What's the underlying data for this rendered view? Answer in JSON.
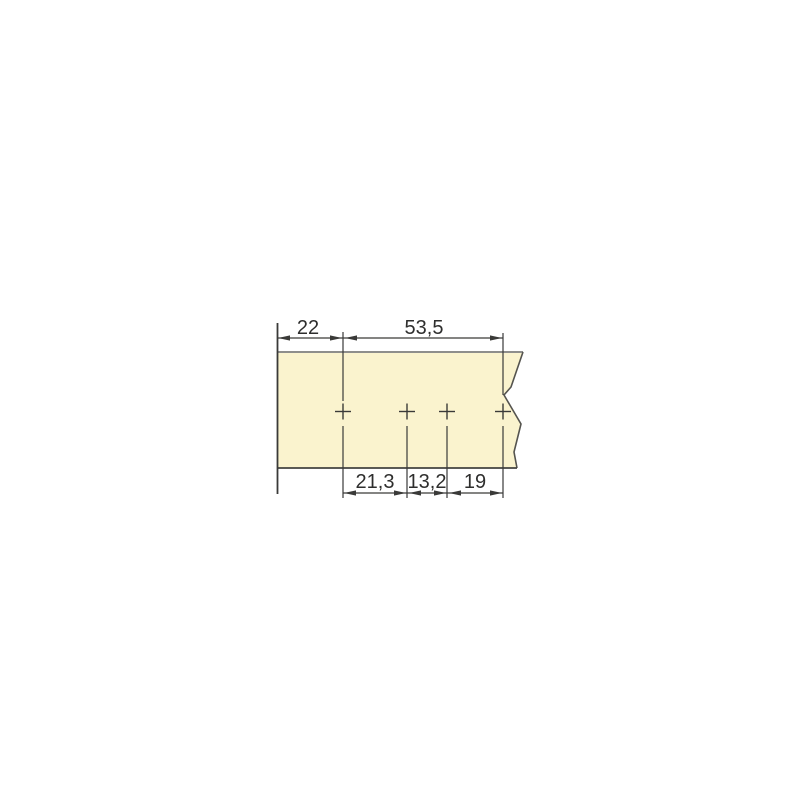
{
  "drawing": {
    "title": "panel-drilling-dimension-drawing",
    "hole_marks": 4,
    "top_dimensions": [
      {
        "label": "22",
        "value": 22
      },
      {
        "label": "53,5",
        "value": 53.5
      }
    ],
    "bottom_dimensions": [
      {
        "label": "21,3",
        "value": 21.3
      },
      {
        "label": "13,2",
        "value": 13.2
      },
      {
        "label": "19",
        "value": 19
      }
    ]
  },
  "colors": {
    "background": "#FFFFFF",
    "panel_fill": "#FAF3CE",
    "panel_top_edge": "#8E8E8C",
    "panel_break_edge": "#55544F",
    "panel_bottom_edge": "#434341",
    "line": "#3A3A38",
    "text": "#2E2E2D"
  }
}
